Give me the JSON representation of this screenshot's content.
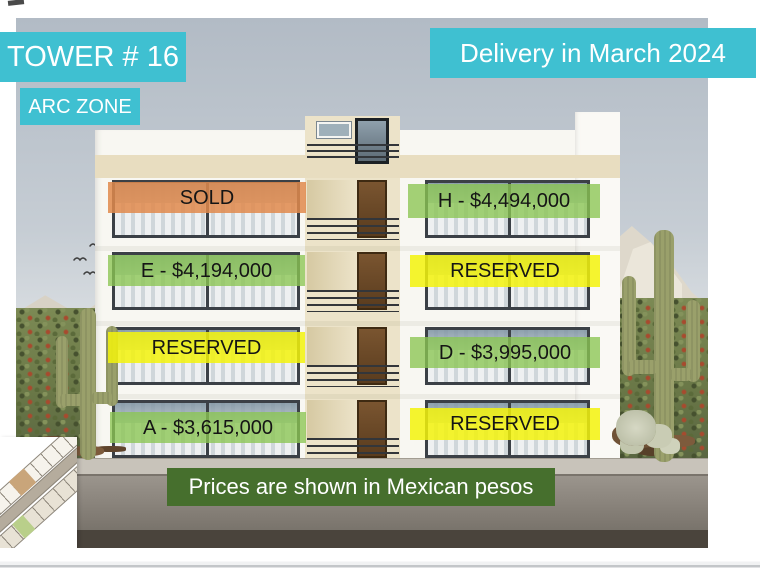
{
  "slide": {
    "tower_label": "TOWER # 16",
    "zone_label": "ARC ZONE",
    "delivery_label": "Delivery in March 2024",
    "footer_note": "Prices are shown in Mexican pesos"
  },
  "status_colors": {
    "sold": "#E18A4C",
    "for_sale": "#8BC552",
    "reserved": "#F3F30C",
    "accent_teal": "#3FC0D1",
    "footer_green": "#466F2D"
  },
  "units": [
    {
      "floor": 4,
      "side": "left",
      "status": "sold",
      "label": "SOLD"
    },
    {
      "floor": 4,
      "side": "right",
      "status": "for_sale",
      "label": "H - $4,494,000"
    },
    {
      "floor": 3,
      "side": "left",
      "status": "for_sale",
      "label": "E - $4,194,000"
    },
    {
      "floor": 3,
      "side": "right",
      "status": "reserved",
      "label": "RESERVED"
    },
    {
      "floor": 2,
      "side": "left",
      "status": "reserved",
      "label": "RESERVED"
    },
    {
      "floor": 2,
      "side": "right",
      "status": "for_sale",
      "label": "D - $3,995,000"
    },
    {
      "floor": 1,
      "side": "left",
      "status": "for_sale",
      "label": "A - $3,615,000"
    },
    {
      "floor": 1,
      "side": "right",
      "status": "reserved",
      "label": "RESERVED"
    }
  ]
}
